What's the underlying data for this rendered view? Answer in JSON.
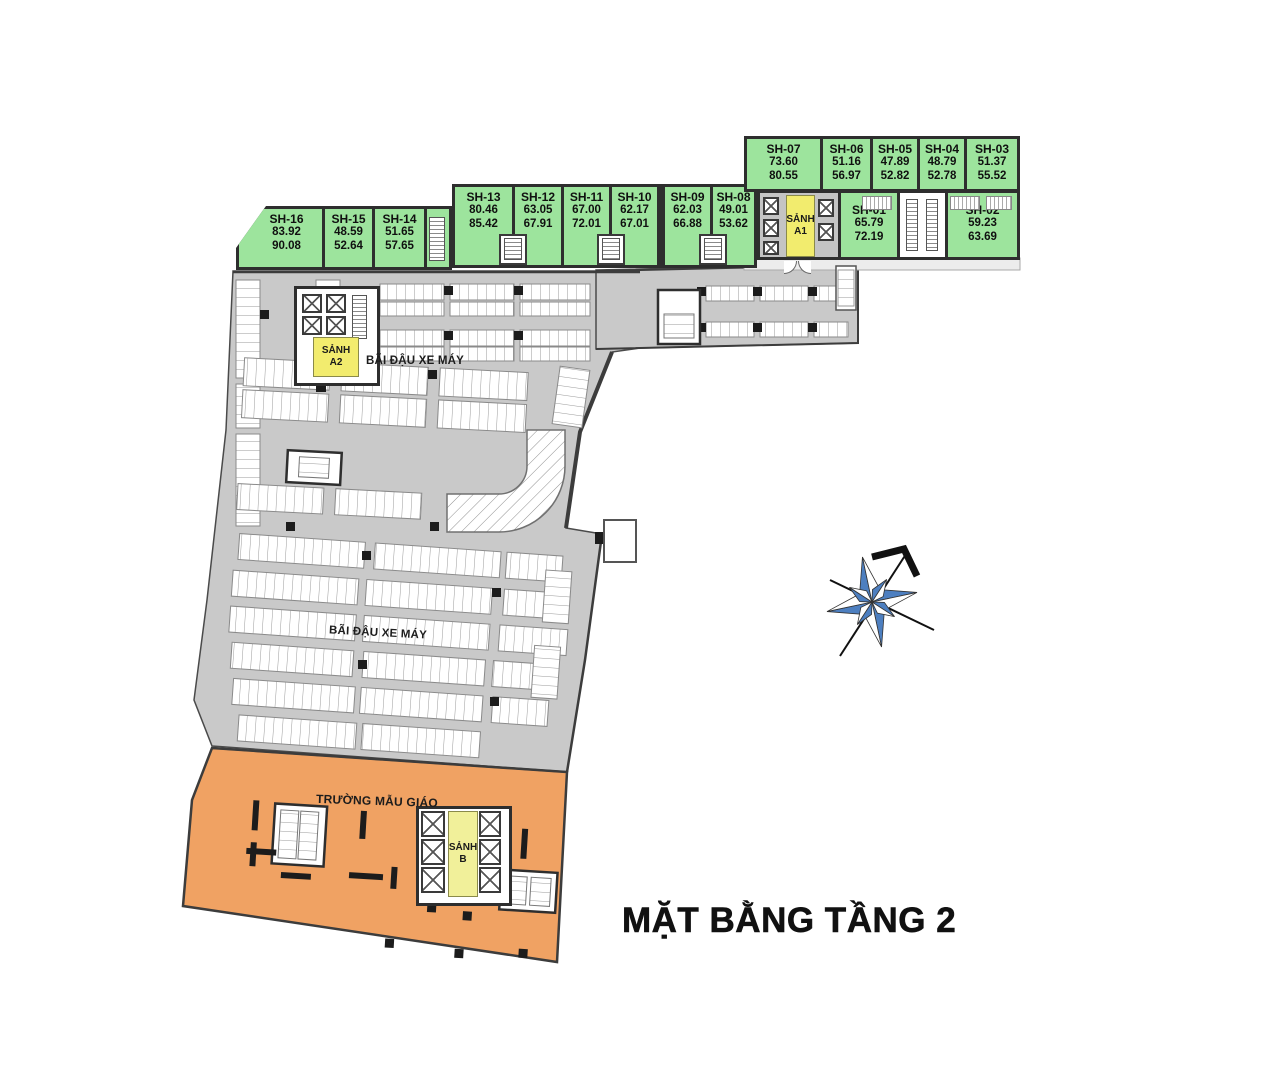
{
  "title": "MẶT BẰNG TẦNG 2",
  "labels": {
    "parking": "BÃI ĐẬU XE MÁY",
    "kindergarten": "TRƯỜNG MẪU GIÁO"
  },
  "lobbies": {
    "a1": {
      "name": "SẢNH",
      "code": "A1"
    },
    "a2": {
      "name": "SẢNH",
      "code": "A2"
    },
    "b": {
      "name": "SẢNH",
      "code": "B"
    }
  },
  "units": [
    {
      "id": "SH-01",
      "area1": "65.79",
      "area2": "72.19"
    },
    {
      "id": "SH-02",
      "area1": "59.23",
      "area2": "63.69"
    },
    {
      "id": "SH-03",
      "area1": "51.37",
      "area2": "55.52"
    },
    {
      "id": "SH-04",
      "area1": "48.79",
      "area2": "52.78"
    },
    {
      "id": "SH-05",
      "area1": "47.89",
      "area2": "52.82"
    },
    {
      "id": "SH-06",
      "area1": "51.16",
      "area2": "56.97"
    },
    {
      "id": "SH-07",
      "area1": "73.60",
      "area2": "80.55"
    },
    {
      "id": "SH-08",
      "area1": "49.01",
      "area2": "53.62"
    },
    {
      "id": "SH-09",
      "area1": "62.03",
      "area2": "66.88"
    },
    {
      "id": "SH-10",
      "area1": "62.17",
      "area2": "67.01"
    },
    {
      "id": "SH-11",
      "area1": "67.00",
      "area2": "72.01"
    },
    {
      "id": "SH-12",
      "area1": "63.05",
      "area2": "67.91"
    },
    {
      "id": "SH-13",
      "area1": "80.46",
      "area2": "85.42"
    },
    {
      "id": "SH-14",
      "area1": "51.65",
      "area2": "57.65"
    },
    {
      "id": "SH-15",
      "area1": "48.59",
      "area2": "52.64"
    },
    {
      "id": "SH-16",
      "area1": "83.92",
      "area2": "90.08"
    }
  ],
  "colors": {
    "unit_green": "#9de49d",
    "lobby_yellow": "#f2ec6e",
    "lobby_yellow_pale": "#f1f09a",
    "parking_gray": "#c9c9c9",
    "kindergarten_orange": "#f0a263",
    "wall_dark": "#2e2e2e",
    "compass_blue": "#4d7fc0"
  }
}
